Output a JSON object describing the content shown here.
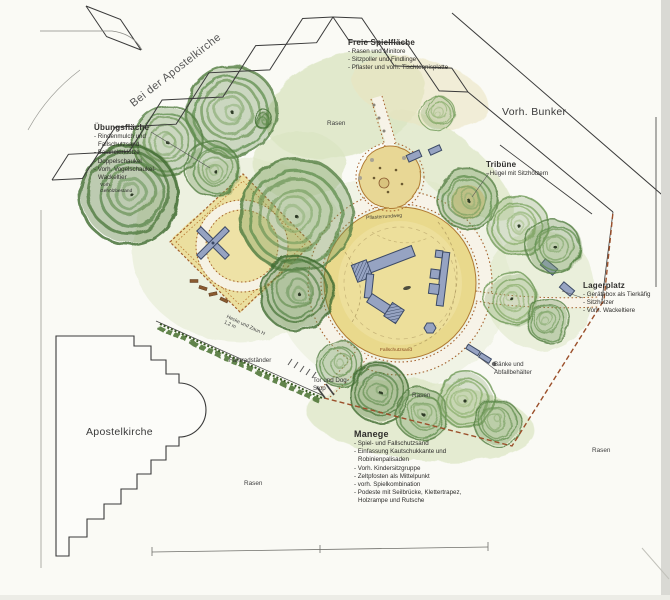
{
  "palette": {
    "paper": "#fafaf5",
    "tree_green": "#4e7a3f",
    "sand_yellow": "#e9d98c",
    "path_edging_brown": "#a5602c",
    "equipment_blue": "#96a3c2",
    "boundary_black": "#3a3a3a"
  },
  "areas": {
    "freie_spielflaeche": {
      "title": "Freie Spielfläche",
      "items": [
        "- Rasen und Minitore",
        "- Sitzpoller und Findlinge",
        "- Pflaster und vorh. Tischtennisplatte"
      ]
    },
    "uebungsflaeche": {
      "title": "Übungsfläche",
      "items": [
        "- Rindenmulch und Fallschutzsand",
        "- Balancierklötze",
        "- Doppelschaukel",
        "- Vorh. Vogelschaukel-Wackeltier"
      ]
    },
    "tribuene": {
      "title": "Tribüne",
      "items": [
        "- Hügel mit Sitzhölzern"
      ]
    },
    "lagerplatz": {
      "title": "Lagerplatz",
      "items": [
        "- Gerätebox als Tierkäfig",
        "- Sitzhölzer",
        "- Vorh. Wackeltiere"
      ]
    },
    "manege": {
      "title": "Manege",
      "items": [
        "- Spiel- und Fallschutzsand",
        "- Einfassung Kautschukkante und Robinienpalisaden",
        "- Vorh. Kindersitzgruppe",
        "- Zeltpfosten als Mittelpunkt",
        "- vorh. Spielkombination",
        "- Podeste mit Seilbrücke, Klettertrapez, Holzrampe und Rutsche"
      ]
    }
  },
  "labels": {
    "street": "Bei der Apostelkirche",
    "vorh_bunker": "Vorh. Bunker",
    "apostelkirche": "Apostelkirche",
    "pflasterrundweg": "Pflasterrundweg",
    "fahrradstaender": "Fahrradständer",
    "tor_dog_stop": "Tor und Dog-Stop",
    "baenke": "Bänke und Abfallbehälter",
    "hecke_zaun": "Hecke und Zaun H 1,2 m",
    "fallschutzsand": "Fallschutzsand",
    "gehoelzbestand": "Vorh. Gehölzbestand",
    "rasen": "Rasen"
  }
}
